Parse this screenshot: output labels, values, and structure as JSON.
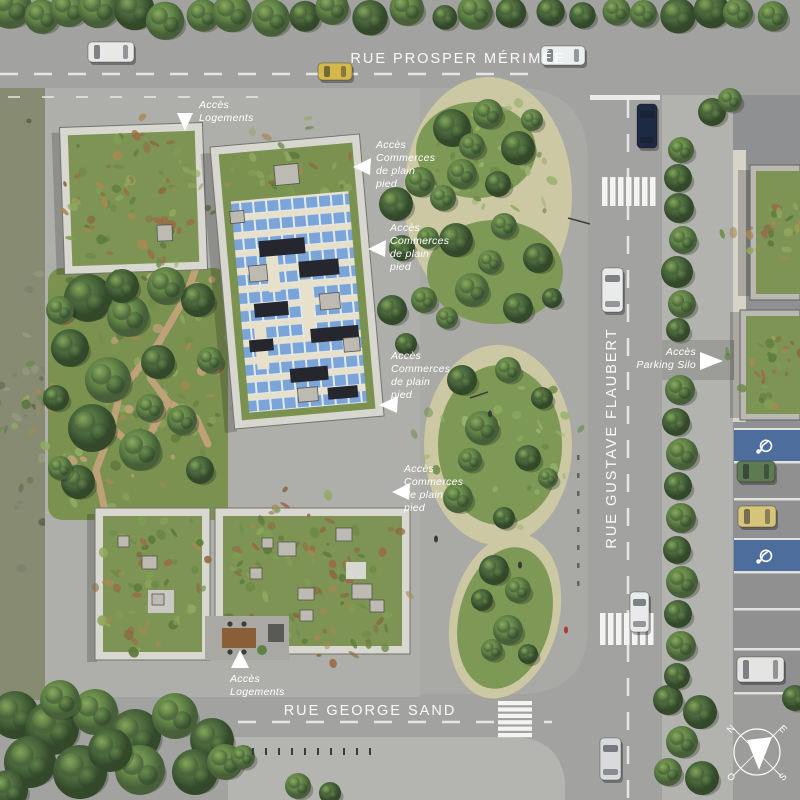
{
  "streets": {
    "top": "RUE PROSPER MÉRIMÉE",
    "right": "RUE GUSTAVE FLAUBERT",
    "bottom": "RUE GEORGE SAND"
  },
  "annotations": {
    "logements": {
      "l1": "Accès",
      "l2": "Logements"
    },
    "commerces": {
      "l1": "Accès",
      "l2": "Commerces",
      "l3": "de plain",
      "l4": "pied"
    },
    "parking_silo": {
      "l1": "Accès",
      "l2": "Parking Silo"
    }
  },
  "compass": {
    "n": "N",
    "e": "E",
    "s": "S",
    "o": "O"
  },
  "icons": {
    "wheelchair-icon": "♿",
    "access-arrow-down-icon": "▼",
    "access-arrow-left-icon": "◀",
    "access-arrow-right-icon": "▶",
    "access-arrow-up-icon": "▲",
    "compass-rose-icon": "✛"
  },
  "palette": {
    "road": "#a2a2a0",
    "pavement": "#aeaeab",
    "plaza": "#a9a9a6",
    "gravel": "#ccc8a4",
    "garden_green": "#7a9150",
    "roof_green": "#7d9454",
    "solar_blue": "#7ba4d8",
    "tree_dark": "#3f5c33",
    "tree_light": "#5f8245",
    "scrub": "#878b72",
    "marking_white": "#f2f2f2",
    "handicap_blue": "#4d6e9c",
    "label_white": "#ffffff"
  }
}
